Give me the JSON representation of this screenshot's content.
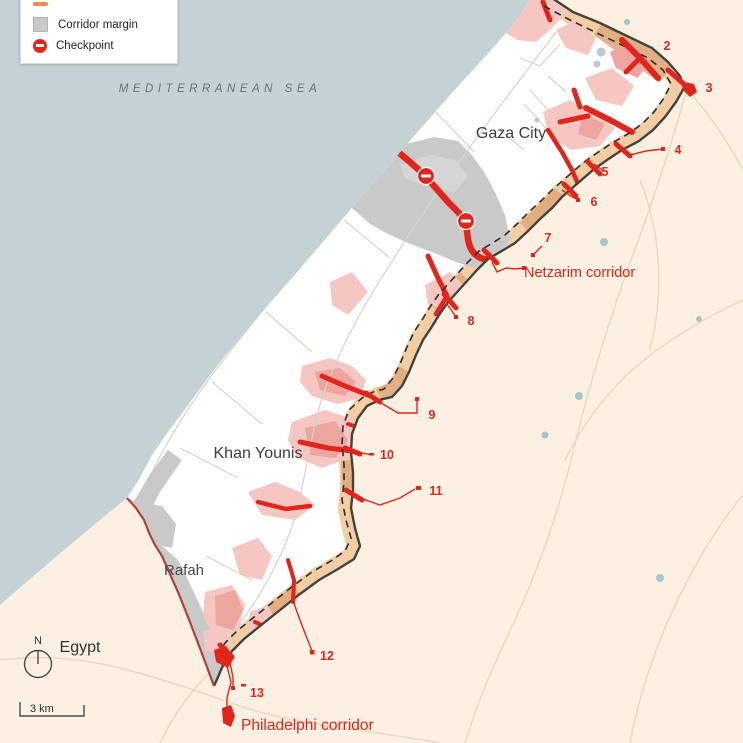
{
  "legend": {
    "items": [
      {
        "label": "",
        "swatch": "corridor-line"
      },
      {
        "label": "Corridor margin",
        "swatch": "gray-square"
      },
      {
        "label": "Checkpoint",
        "swatch": "checkpoint-dot"
      }
    ]
  },
  "sea": {
    "label": "MEDITERRANEAN SEA"
  },
  "places": {
    "gaza_city": "Gaza City",
    "khan_younis": "Khan Younis",
    "rafah": "Rafah",
    "egypt": "Egypt"
  },
  "corridors": {
    "netzarim": "Netzarim corridor",
    "philadelphi": "Philadelphi corridor"
  },
  "checkpoints": [
    {
      "label": "2"
    },
    {
      "label": "3"
    },
    {
      "label": "4"
    },
    {
      "label": "5"
    },
    {
      "label": "6"
    },
    {
      "label": "7"
    },
    {
      "label": "8"
    },
    {
      "label": "9"
    },
    {
      "label": "10"
    },
    {
      "label": "11"
    },
    {
      "label": "12"
    },
    {
      "label": "13"
    }
  ],
  "compass": {
    "north": "N"
  },
  "scale": {
    "label": "3 km"
  },
  "colors": {
    "sea": "#c4d2d5",
    "land_outside": "#fbf0e1",
    "strip_interior": "#ffffff",
    "buffer_zone": "#f3cda4",
    "buffer_dark": "#dfa87c",
    "corridor_margin": "#c9c9c9",
    "urban_light": "#f5c6c2",
    "urban_medium": "#eda59f",
    "road_red": "#e1251b",
    "label_red": "#e1251b",
    "egypt_border": "#ae423a",
    "border_dark": "#44423c"
  }
}
